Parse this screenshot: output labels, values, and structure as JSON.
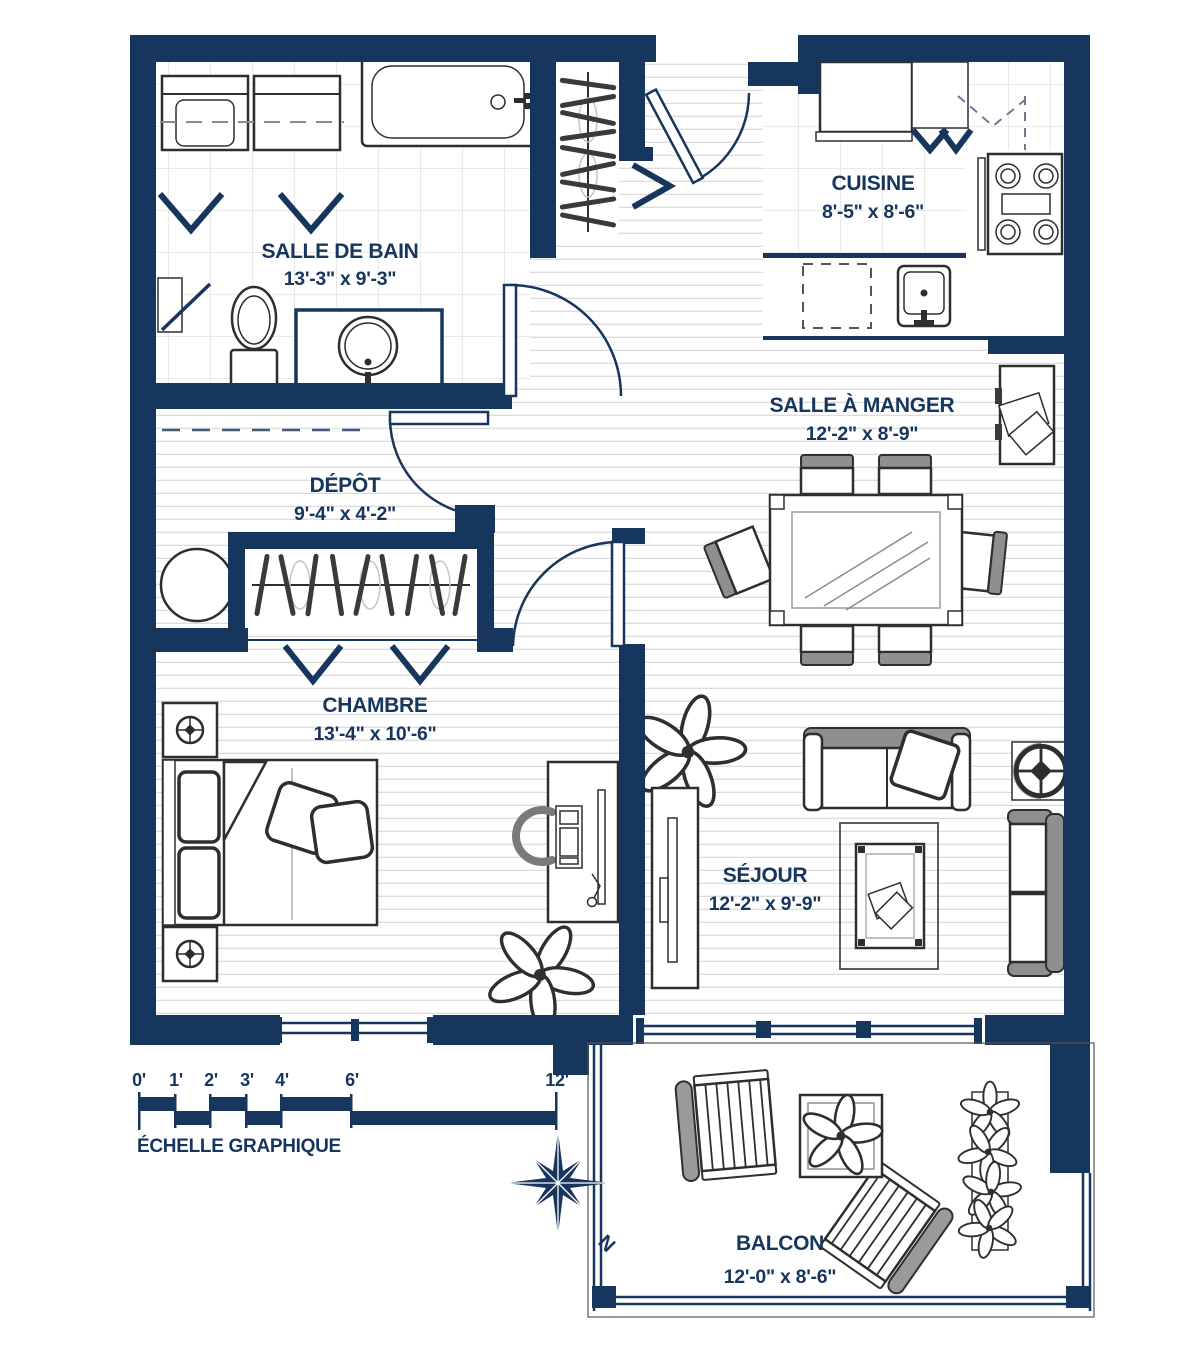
{
  "plan": {
    "rooms": [
      {
        "name": "SALLE DE BAIN",
        "dims": "13'-3\" x 9'-3\""
      },
      {
        "name": "CUISINE",
        "dims": "8'-5\" x 8'-6\""
      },
      {
        "name": "SALLE À MANGER",
        "dims": "12'-2\" x 8'-9\""
      },
      {
        "name": "DÉPÔT",
        "dims": "9'-4\" x 4'-2\""
      },
      {
        "name": "CHAMBRE",
        "dims": "13'-4\" x 10'-6\""
      },
      {
        "name": "SÉJOUR",
        "dims": "12'-2\" x 9'-9\""
      },
      {
        "name": "BALCON",
        "dims": "12'-0\" x 8'-6\""
      }
    ],
    "scale_bar": {
      "label": "ÉCHELLE GRAPHIQUE",
      "ticks": [
        "0'",
        "1'",
        "2'",
        "3'",
        "4'",
        "6'",
        "12'"
      ]
    },
    "compass": {
      "north": "N"
    },
    "colors": {
      "wall": "#17365D",
      "text": "#17365D"
    }
  }
}
